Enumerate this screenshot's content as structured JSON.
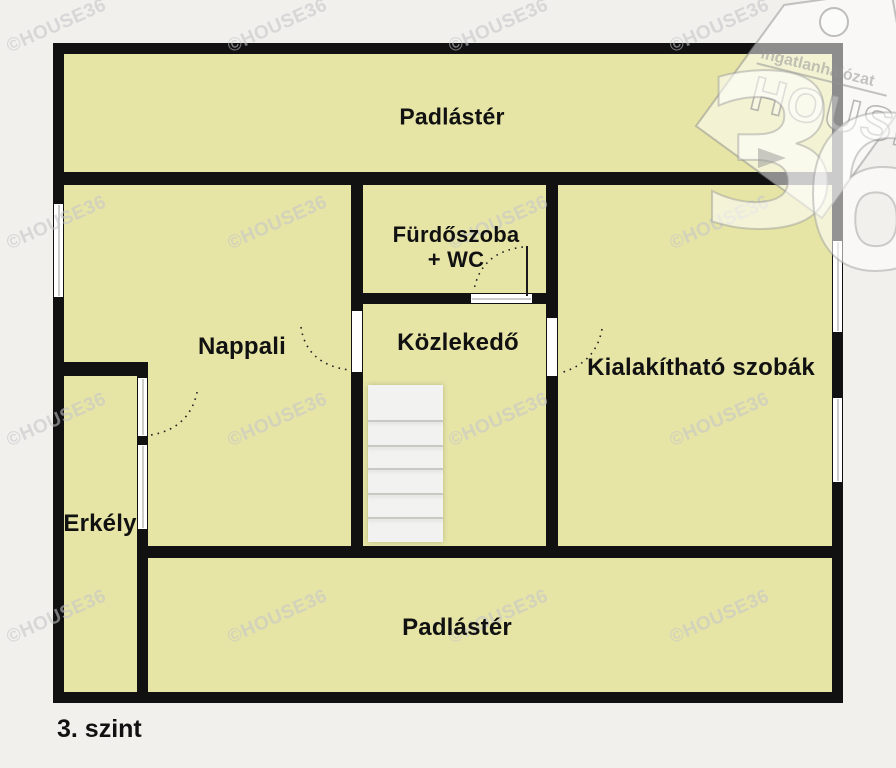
{
  "meta": {
    "floor_label": "3. szint",
    "watermark_text": "©HOUSE36"
  },
  "rooms": [
    {
      "id": "padlaster-top",
      "label": "Padlástér"
    },
    {
      "id": "nappali",
      "label": "Nappali"
    },
    {
      "id": "furdoszoba",
      "label": "Fürdőszoba",
      "label2": "+ WC"
    },
    {
      "id": "kozlekedo",
      "label": "Közlekedő"
    },
    {
      "id": "kialakithato",
      "label": "Kialakítható szobák"
    },
    {
      "id": "erkely",
      "label": "Erkély"
    },
    {
      "id": "padlaster-bottom",
      "label": "Padlástér"
    }
  ],
  "logo": {
    "brand_top": "ingatlanhálózat",
    "brand_main": "HOUSE",
    "brand_number_3": "3",
    "brand_number_6": "6"
  },
  "colors": {
    "background": "#f2f0ec",
    "floor_fill": "#e6e5a6",
    "wall": "#111111",
    "label_ink": "#111111"
  }
}
